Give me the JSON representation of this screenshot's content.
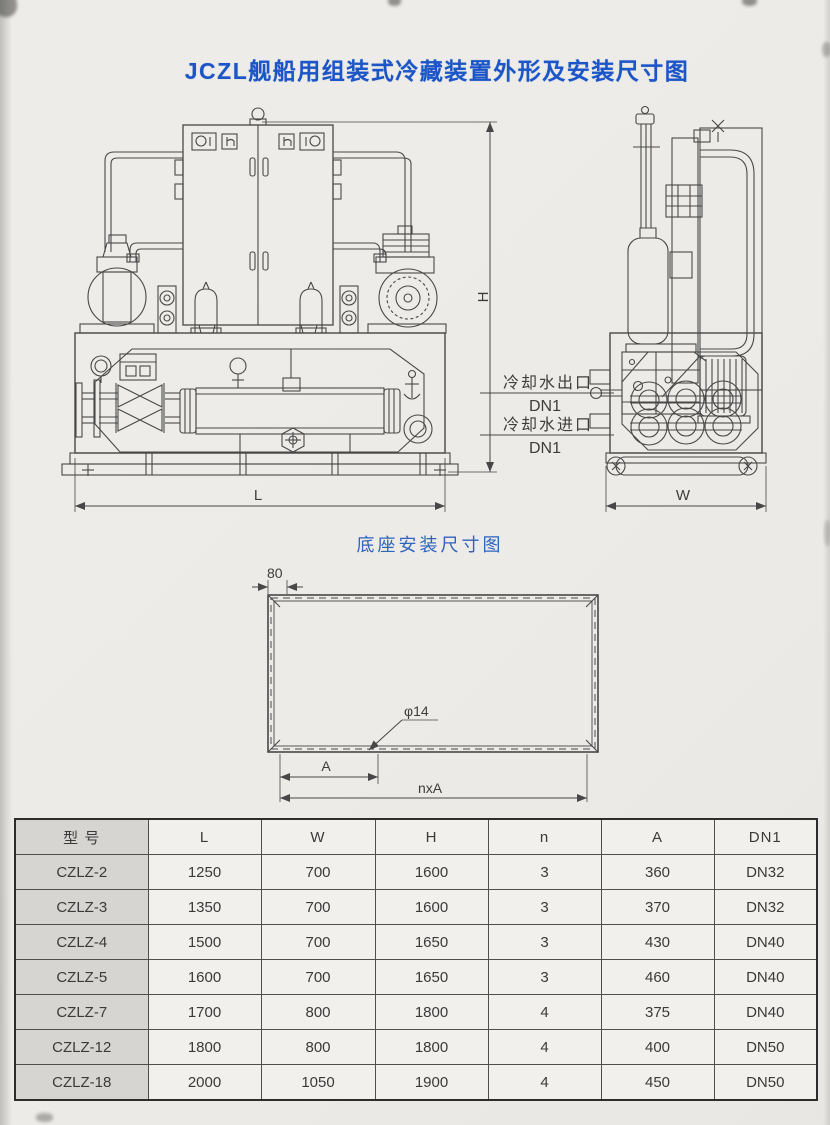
{
  "page": {
    "title": "JCZL舰船用组装式冷藏装置外形及安装尺寸图",
    "base_title": "底座安装尺寸图"
  },
  "colors": {
    "title_blue": "#1b55c7",
    "subtitle_blue": "#2f63be",
    "line_gray": "#484848"
  },
  "drawing": {
    "dim_h": "H",
    "dim_l": "L",
    "dim_w": "W",
    "cooling_water_outlet": "冷却水出口",
    "cooling_water_outlet_dn": "DN1",
    "cooling_water_inlet": "冷却水进口",
    "cooling_water_inlet_dn": "DN1"
  },
  "base_drawing": {
    "dim_edge": "80",
    "dim_hole": "φ14",
    "dim_a": "A",
    "dim_nxa": "nxA"
  },
  "table": {
    "headers": [
      "型 号",
      "L",
      "W",
      "H",
      "n",
      "A",
      "DN1"
    ],
    "rows": [
      {
        "model": "CZLZ-2",
        "l": "1250",
        "w": "700",
        "h": "1600",
        "n": "3",
        "a": "360",
        "dn1": "DN32"
      },
      {
        "model": "CZLZ-3",
        "l": "1350",
        "w": "700",
        "h": "1600",
        "n": "3",
        "a": "370",
        "dn1": "DN32"
      },
      {
        "model": "CZLZ-4",
        "l": "1500",
        "w": "700",
        "h": "1650",
        "n": "3",
        "a": "430",
        "dn1": "DN40"
      },
      {
        "model": "CZLZ-5",
        "l": "1600",
        "w": "700",
        "h": "1650",
        "n": "3",
        "a": "460",
        "dn1": "DN40"
      },
      {
        "model": "CZLZ-7",
        "l": "1700",
        "w": "800",
        "h": "1800",
        "n": "4",
        "a": "375",
        "dn1": "DN40"
      },
      {
        "model": "CZLZ-12",
        "l": "1800",
        "w": "800",
        "h": "1800",
        "n": "4",
        "a": "400",
        "dn1": "DN50"
      },
      {
        "model": "CZLZ-18",
        "l": "2000",
        "w": "1050",
        "h": "1900",
        "n": "4",
        "a": "450",
        "dn1": "DN50"
      }
    ]
  }
}
